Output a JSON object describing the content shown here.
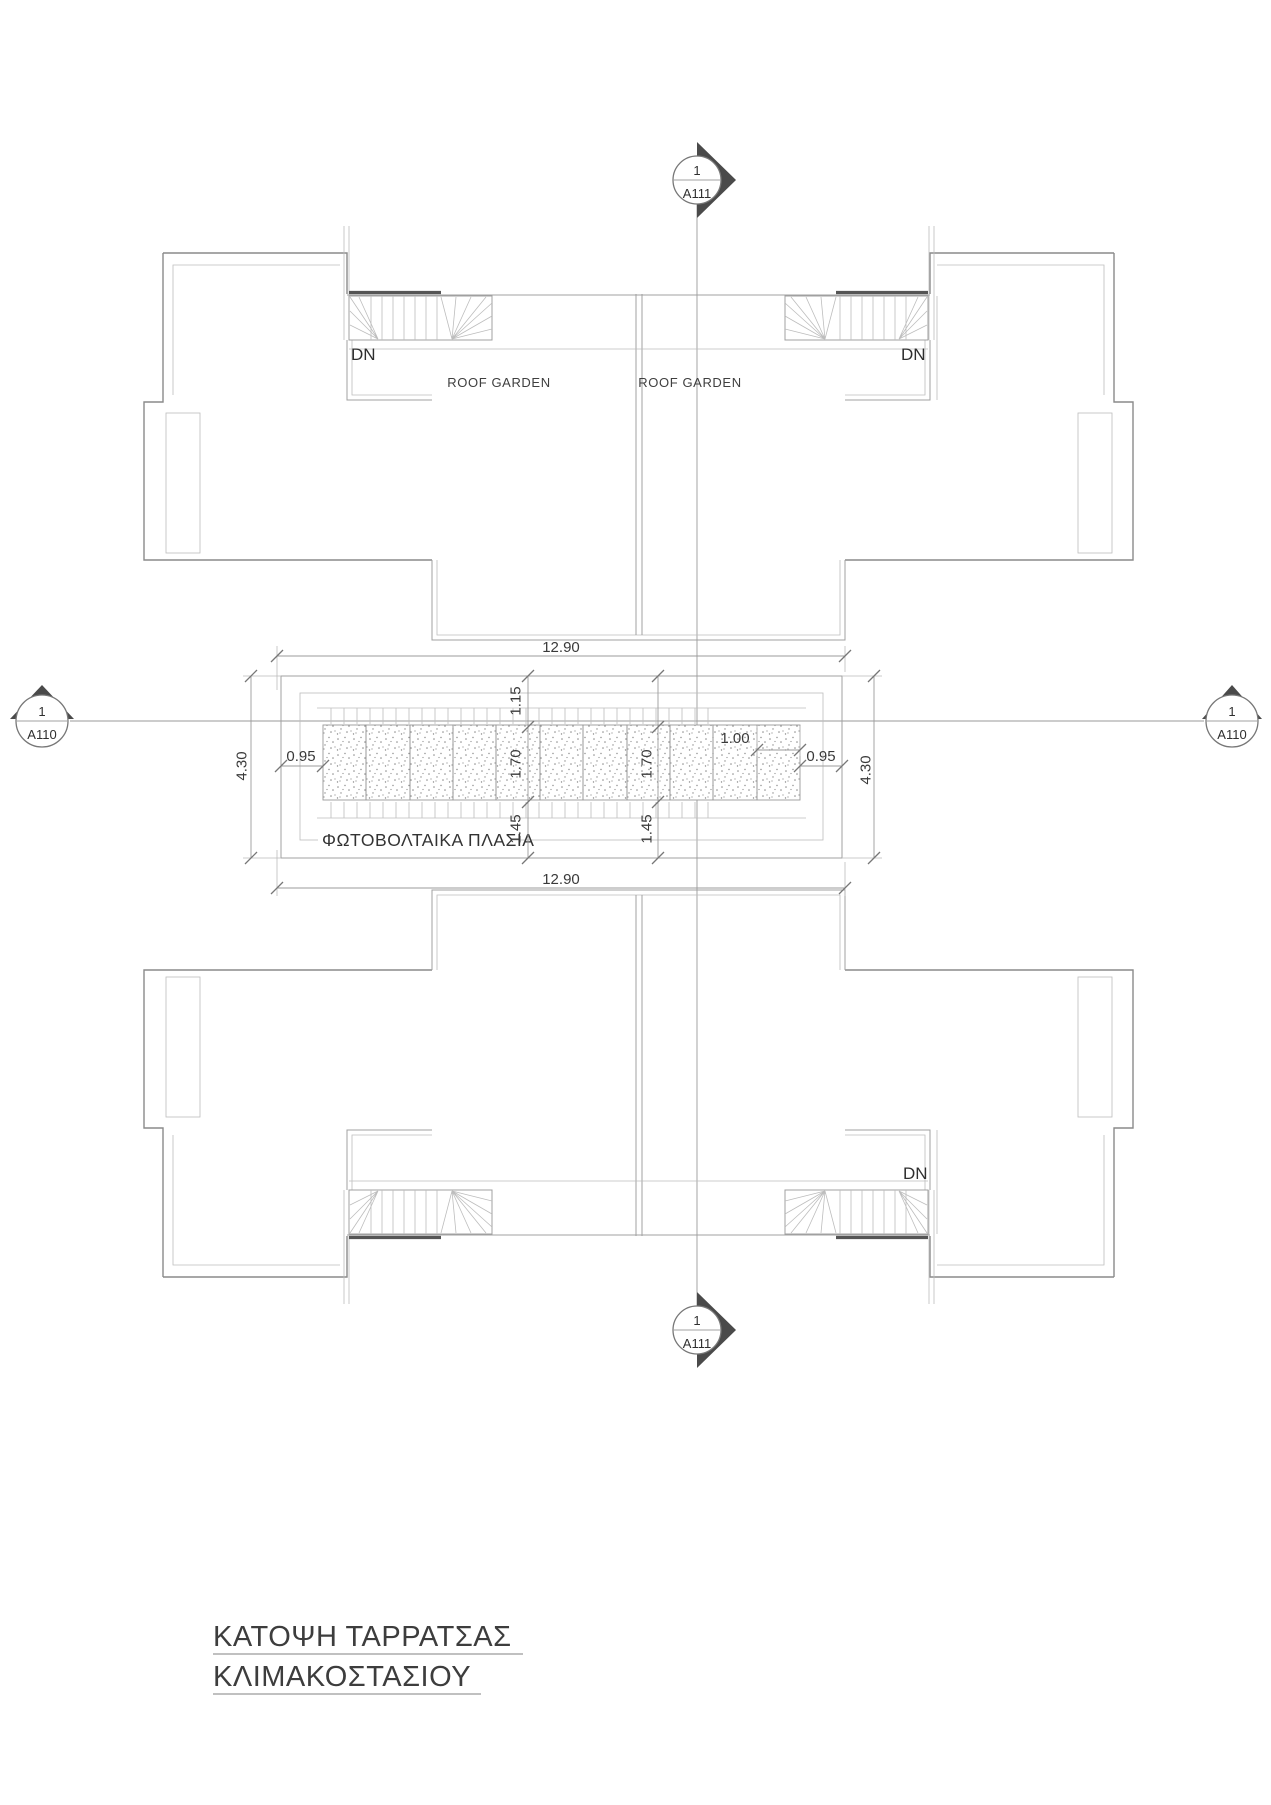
{
  "drawing": {
    "title": {
      "line1": "ΚΑΤΟΨΗ ΤΑΡΡΑΤΣΑΣ",
      "line2": "ΚΛΙΜΑΚΟΣΤΑΣΙΟΥ"
    },
    "labels": {
      "roof_garden_left": "ROOF GARDEN",
      "roof_garden_right": "ROOF GARDEN",
      "photovoltaic_panels": "ΦΩΤΟΒΟΛΤΑΙΚΑ ΠΛΑΣΙΑ",
      "down_top_left": "DN",
      "down_top_right": "DN",
      "down_bottom_right": "DN"
    },
    "section_markers": {
      "top": {
        "detail_number": "1",
        "sheet_number": "A111"
      },
      "bottom": {
        "detail_number": "1",
        "sheet_number": "A111"
      },
      "left": {
        "detail_number": "1",
        "sheet_number": "A110"
      },
      "right": {
        "detail_number": "1",
        "sheet_number": "A110"
      }
    },
    "dimensions": {
      "strip_width_top": "12.90",
      "strip_width_bottom": "12.90",
      "strip_height_left": "4.30",
      "strip_height_right": "4.30",
      "edge_gap_left": "0.95",
      "edge_gap_right": "0.95",
      "offset_top": "1.15",
      "panel_height_left": "1.70",
      "panel_height_right": "1.70",
      "panel_width": "1.00",
      "offset_bottom_left": "1.45",
      "offset_bottom_right": "1.45"
    },
    "colors": {
      "wall_line": "#8a8a8a",
      "light_line": "#bdbdbd",
      "text": "#3a3a3a",
      "marker_fill": "#4a4a4a",
      "background": "#ffffff"
    }
  }
}
